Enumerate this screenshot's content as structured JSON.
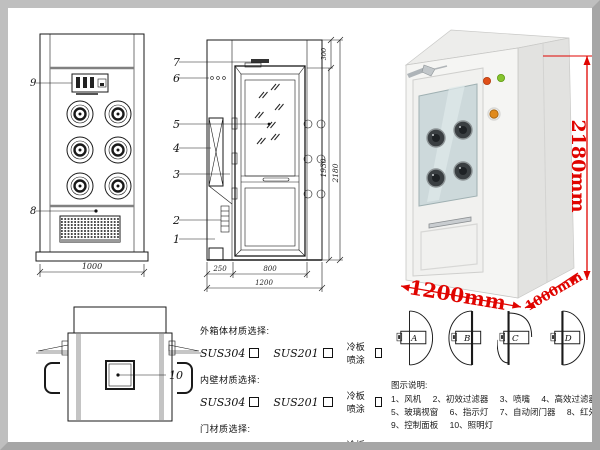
{
  "front_view": {
    "callout_9": "9",
    "callout_8": "8",
    "dim_width": "1000"
  },
  "side_view": {
    "callouts": {
      "c1": "1",
      "c2": "2",
      "c3": "3",
      "c4": "4",
      "c5": "5",
      "c6": "6",
      "c7": "7"
    },
    "dims": {
      "top": "300",
      "inner_height": "1930",
      "total_height": "2180",
      "left": "250",
      "door": "800",
      "total": "1200"
    }
  },
  "photo": {
    "dim_height": "2180mm",
    "dim_width": "1200mm",
    "dim_depth": "1000mm",
    "colors": {
      "dimension_red": "#e00400",
      "body_white": "#f5f5f3",
      "glass_blue": "#cdd9db",
      "green_light": "#86c42e",
      "red_light": "#e04f18",
      "orange_button": "#e08a1c"
    }
  },
  "top_view": {
    "callout_10": "10"
  },
  "materials": {
    "groups": [
      {
        "title": "外箱体材质选择:",
        "options": [
          {
            "label": "SUS304"
          },
          {
            "label": "SUS201"
          },
          {
            "label": "冷板喷涂"
          }
        ]
      },
      {
        "title": "内壁材质选择:",
        "options": [
          {
            "label": "SUS304"
          },
          {
            "label": "SUS201"
          },
          {
            "label": "冷板喷涂"
          }
        ]
      },
      {
        "title": "门材质选择:",
        "options": [
          {
            "label": "SUS304"
          },
          {
            "label": "SUS201"
          },
          {
            "label": "冷板喷涂"
          }
        ]
      }
    ]
  },
  "door_options": {
    "labels": [
      "A",
      "B",
      "C",
      "D"
    ]
  },
  "legend": {
    "title": "图示说明:",
    "rows": [
      [
        "1、风机",
        "2、初效过滤器",
        "3、喷嘴",
        "4、高效过滤器"
      ],
      [
        "5、玻璃视窗",
        "6、指示灯",
        "7、自动闭门器",
        "8、红外线感应器"
      ],
      [
        "9、控制面板",
        "10、照明灯"
      ]
    ]
  }
}
